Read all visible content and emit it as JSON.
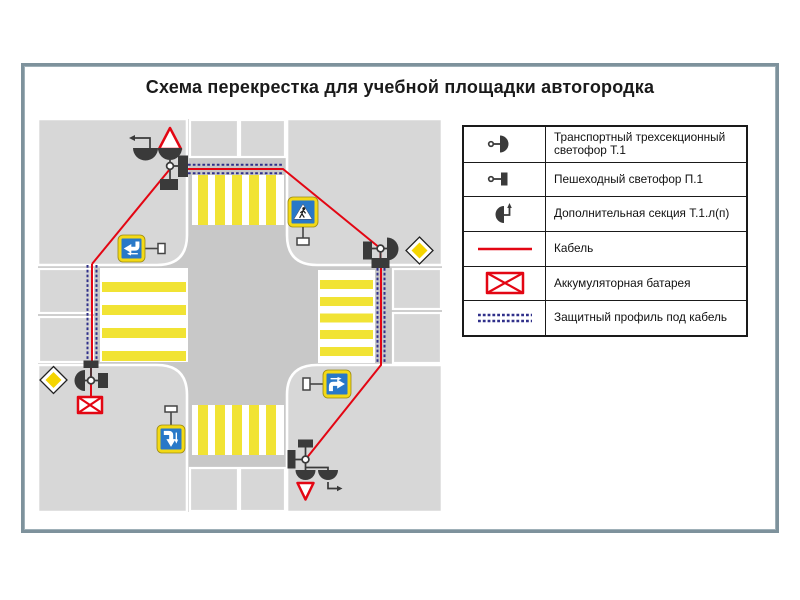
{
  "title": "Схема перекрестка для учебной площадки автогородка",
  "legend": {
    "items": [
      {
        "icon": "transport-light-icon",
        "label": "Транспортный  трехсекционный светофор Т.1"
      },
      {
        "icon": "pedestrian-light-icon",
        "label": "Пешеходный светофор П.1"
      },
      {
        "icon": "additional-section-icon",
        "label": "Дополнительная секция Т.1.л(п)"
      },
      {
        "icon": "cable-line-icon",
        "label": "Кабель"
      },
      {
        "icon": "battery-icon",
        "label": "Аккумуляторная батарея"
      },
      {
        "icon": "protective-profile-icon",
        "label": "Защитный профиль под кабель"
      }
    ]
  },
  "colors": {
    "cable_red": "#e30613",
    "profile_blue": "#30308a",
    "stripe_yellow": "#f1e334",
    "sign_yellow": "#f3d916",
    "diamond_yellow": "#f5d500",
    "sign_blue": "#2878c8",
    "road_gray": "#c8c8c8",
    "block_gray": "#d7d7d7",
    "device_dark": "#3a3a3a",
    "frame_border": "#7e929c",
    "legend_border": "#1a1a1a",
    "text_black": "#1a1a1a"
  }
}
